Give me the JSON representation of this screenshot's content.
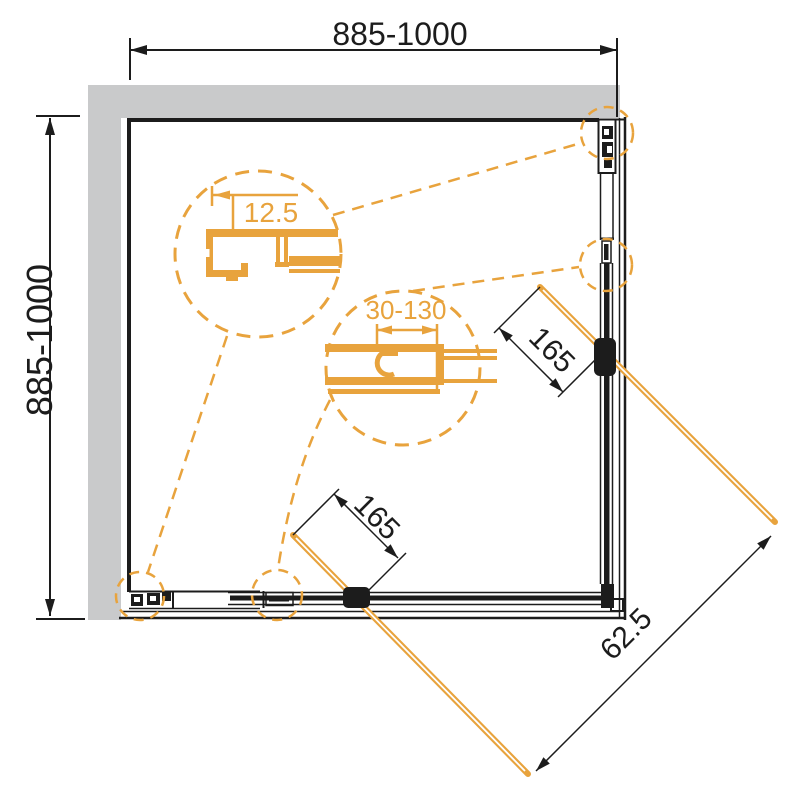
{
  "dimensions": {
    "top_width": "885-1000",
    "left_depth": "885-1000",
    "detail_wall_profile": "12.5",
    "detail_overlap": "30-130",
    "door_right": "165",
    "door_bottom": "165",
    "diagonal_gap": "62.5"
  },
  "colors": {
    "orange": "#E8A33D",
    "gray": "#C9CACB",
    "black": "#1C1C1C",
    "bg": "#FFFFFF"
  }
}
